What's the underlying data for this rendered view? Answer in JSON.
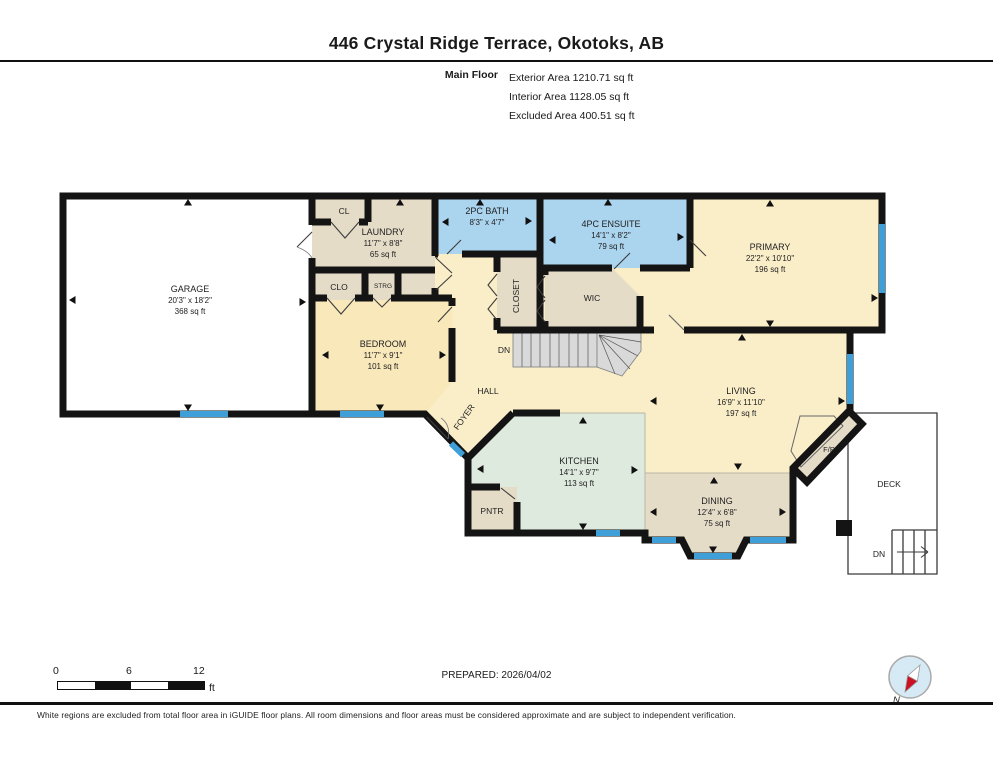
{
  "header": {
    "title": "446 Crystal Ridge Terrace, Okotoks, AB",
    "floor_label": "Main Floor",
    "exterior_area": "Exterior Area 1210.71 sq ft",
    "interior_area": "Interior Area 1128.05 sq ft",
    "excluded_area": "Excluded Area 400.51 sq ft"
  },
  "rooms": {
    "garage": {
      "name": "GARAGE",
      "dims": "20'3\" x 18'2\"",
      "area": "368 sq ft"
    },
    "laundry": {
      "name": "LAUNDRY",
      "dims": "11'7\" x 8'8\"",
      "area": "65 sq ft"
    },
    "bath": {
      "name": "2PC BATH",
      "dims": "8'3\" x 4'7\""
    },
    "ensuite": {
      "name": "4PC ENSUITE",
      "dims": "14'1\" x 8'2\"",
      "area": "79 sq ft"
    },
    "primary": {
      "name": "PRIMARY",
      "dims": "22'2\" x 10'10\"",
      "area": "196 sq ft"
    },
    "bedroom": {
      "name": "BEDROOM",
      "dims": "11'7\" x 9'1\"",
      "area": "101 sq ft"
    },
    "kitchen": {
      "name": "KITCHEN",
      "dims": "14'1\" x 9'7\"",
      "area": "113 sq ft"
    },
    "living": {
      "name": "LIVING",
      "dims": "16'9\" x 11'10\"",
      "area": "197 sq ft"
    },
    "dining": {
      "name": "DINING",
      "dims": "12'4\" x 6'8\"",
      "area": "75 sq ft"
    }
  },
  "labels": {
    "cl": "CL",
    "clo": "CLO",
    "strg": "STRG",
    "closet": "CLOSET",
    "wic": "WIC",
    "hall": "HALL",
    "foyer": "FOYER",
    "pntr": "PNTR",
    "fp": "F/P",
    "deck": "DECK",
    "dn": "DN"
  },
  "footer": {
    "prepared": "PREPARED: 2026/04/02",
    "disclaimer": "White regions are excluded from total floor area in iGUIDE floor plans. All room dimensions and floor areas must be considered approximate and are subject to independent verification.",
    "scale": {
      "start": "0",
      "mid": "6",
      "end": "12",
      "unit": "ft"
    },
    "compass_n": "N"
  },
  "palette": {
    "wall": "#141414",
    "window": "#3f9fd8",
    "room_yellow": "#faeec9",
    "room_bedroom": "#f8e8ba",
    "room_tan": "#e5dcc8",
    "room_blue": "#abd4ee",
    "room_green": "#dfeade",
    "stairs_gray": "#d9d9d9",
    "excluded_white": "#ffffff",
    "compass_red": "#cc1122",
    "compass_blue": "#d6eaf6"
  }
}
